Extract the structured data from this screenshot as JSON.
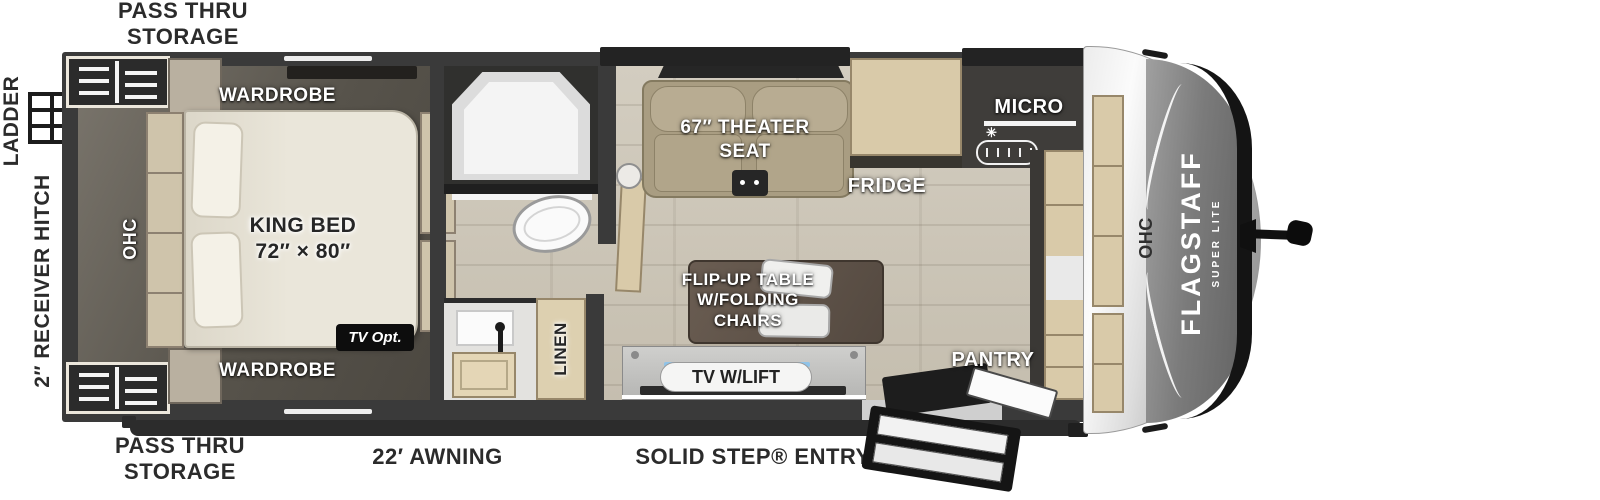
{
  "plan": {
    "exterior": {
      "pass_thru_storage_top": "PASS THRU\nSTORAGE",
      "pass_thru_storage_bottom": "PASS THRU\nSTORAGE",
      "ladder": "LADDER",
      "receiver_hitch": "2″ RECEIVER HITCH",
      "awning": "22′ AWNING",
      "solid_step_entry": "SOLID STEP® ENTRY"
    },
    "bedroom": {
      "wardrobe_top": "WARDROBE",
      "wardrobe_bottom": "WARDROBE",
      "king_bed": "KING BED\n72″ × 80″",
      "ohc": "OHC",
      "tv_opt": "TV Opt."
    },
    "bathroom": {
      "linen": "LINEN"
    },
    "kitchen_living": {
      "theater_seat": "67″ THEATER\nSEAT",
      "fridge": "FRIDGE",
      "micro": "MICRO",
      "flip_up_table": "FLIP-UP TABLE\nW/FOLDING\nCHAIRS",
      "tv_w_lift": "TV W/LIFT",
      "pantry": "PANTRY",
      "ohc": "OHC"
    },
    "brand": {
      "name": "FLAGSTAFF",
      "series": "SUPER LITE"
    },
    "colors": {
      "wall": "#3a3a3a",
      "floor_light": "#cbc5b7",
      "floor_dark": "#534e47",
      "cabinet_tan": "#d9caa9",
      "table_brown": "#5c5046",
      "label_dark": "#2b2b2b",
      "badge_black": "#0d0d0d"
    }
  }
}
